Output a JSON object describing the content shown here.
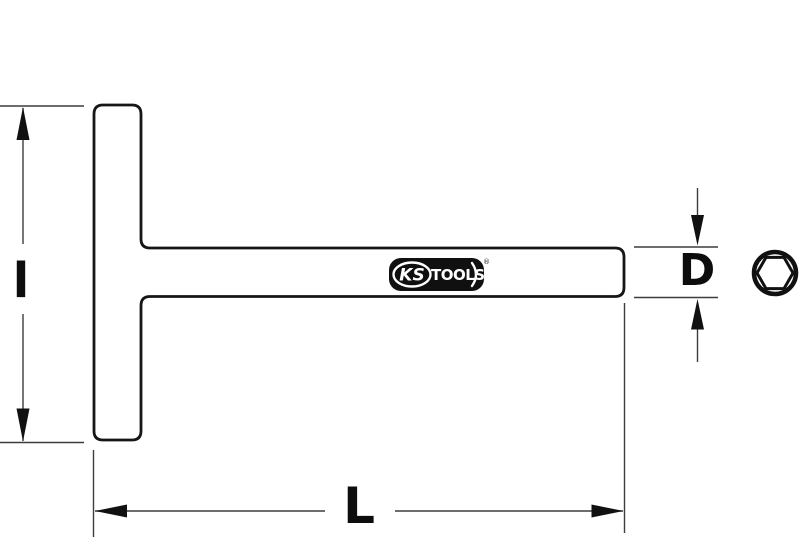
{
  "drawing": {
    "type": "technical-dimension-drawing",
    "subject": "T-handle socket wrench with hex socket end view",
    "labels": {
      "handle_length": "l",
      "shaft_diameter": "D",
      "total_length": "L"
    },
    "logo": {
      "ks": "KS",
      "tools": "TOOLS",
      "registered": "®"
    },
    "colors": {
      "background": "#ffffff",
      "part_outline": "#161616",
      "dimension_line": "#3d3d3d",
      "arrow_fill": "#111111",
      "label_text": "#0d0d0d",
      "logo_background": "#101010",
      "logo_text": "#ffffff"
    }
  }
}
